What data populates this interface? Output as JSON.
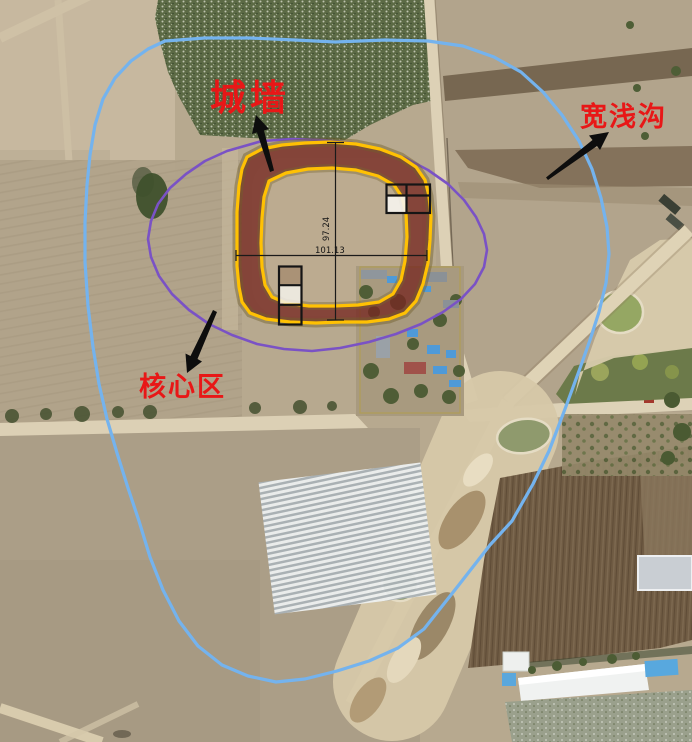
{
  "figure": {
    "type": "annotated-aerial-site-plan",
    "labels": {
      "city_wall": {
        "text": "城墙",
        "color": "#e81717"
      },
      "wide_shallow_ditch": {
        "text": "宽浅沟",
        "color": "#e81717"
      },
      "core_area": {
        "text": "核心区",
        "color": "#e81717"
      }
    },
    "measurements": {
      "wall_height_m": "97.24",
      "wall_width_m": "101.13"
    },
    "overlays": {
      "ditch_outline_color": "#74b3ee",
      "core_outline_color": "#7a52c5",
      "wall_outline_color": "#ffc103",
      "wall_fill_color": "rgba(118,40,33,0.78)",
      "trench_outline_color": "#151515",
      "dimension_line_color": "#1a1a1a",
      "arrow_color": "#0d0d0d"
    }
  }
}
